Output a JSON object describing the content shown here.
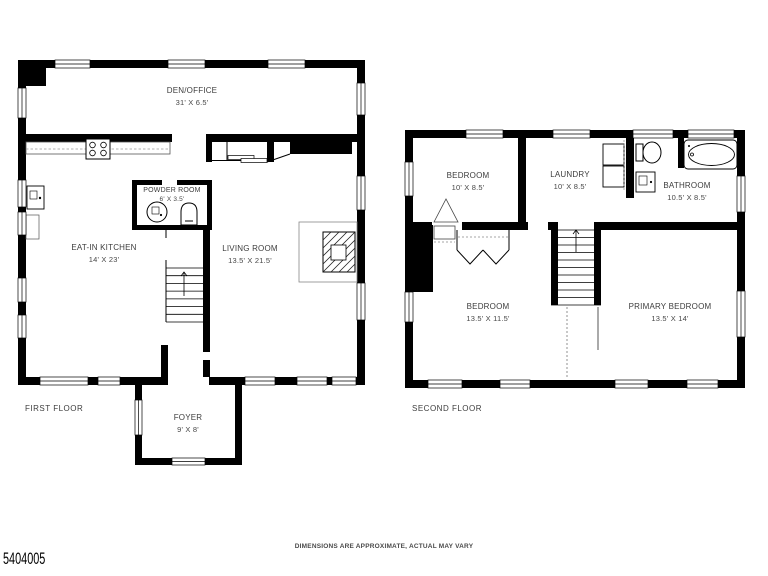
{
  "meta": {
    "photo_id": "5404005",
    "disclaimer": "DIMENSIONS ARE APPROXIMATE, ACTUAL MAY VARY"
  },
  "colors": {
    "wall": "#000000",
    "label_text": "#3d3d3d",
    "background": "#ffffff"
  },
  "first_floor": {
    "label": "FIRST FLOOR",
    "rooms": {
      "den_office": {
        "name": "DEN/OFFICE",
        "dims": "31' X 6.5'"
      },
      "powder_room": {
        "name": "POWDER ROOM",
        "dims": "6' X 3.5'"
      },
      "eat_in_kitchen": {
        "name": "EAT-IN KITCHEN",
        "dims": "14' X 23'"
      },
      "living_room": {
        "name": "LIVING ROOM",
        "dims": "13.5' X 21.5'"
      },
      "foyer": {
        "name": "FOYER",
        "dims": "9' X 8'"
      }
    }
  },
  "second_floor": {
    "label": "SECOND FLOOR",
    "rooms": {
      "bedroom_top": {
        "name": "BEDROOM",
        "dims": "10' X 8.5'"
      },
      "laundry": {
        "name": "LAUNDRY",
        "dims": "10' X 8.5'"
      },
      "bathroom": {
        "name": "BATHROOM",
        "dims": "10.5' X 8.5'"
      },
      "bedroom_bottom": {
        "name": "BEDROOM",
        "dims": "13.5' X 11.5'"
      },
      "primary_bedroom": {
        "name": "PRIMARY BEDROOM",
        "dims": "13.5' X 14'"
      }
    }
  }
}
